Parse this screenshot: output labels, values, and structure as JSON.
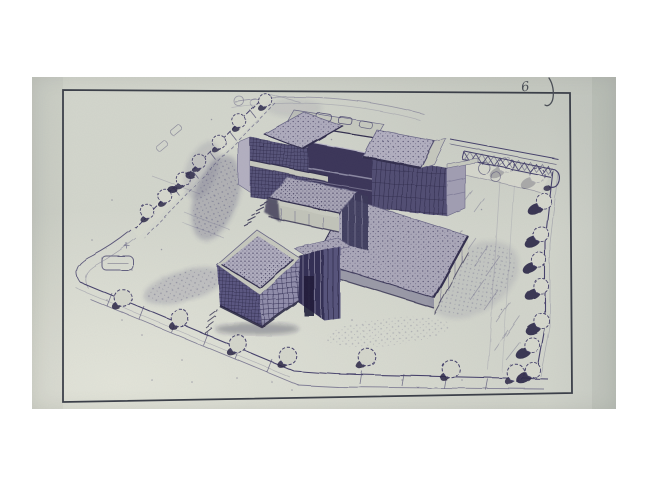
{
  "document": {
    "kind": "scanned architectural perspective drawing",
    "subject": "aerial perspective rendering of a flat-roofed modernist building complex on a landscaped corner site",
    "annotation_glyph": "6",
    "annotation_note": "handwritten pencil mark with hook stroke, top-right above the border"
  },
  "scene": {
    "frame": "hand-drawn rectangular border around the drawing",
    "building_parts": [
      "rear slab with gridded curtain-wall facade",
      "left rooftop box with stippled roof",
      "dark middle rooftop box with window band",
      "right rooftop box with stippled roof",
      "front terrace parapet",
      "front-centre stippled-roof block",
      "front cube pavilion with gridded facades",
      "recessed entrance link with vertical mullions",
      "low right wing with stippled roof and light walls",
      "entry steps"
    ],
    "site_features": [
      "tree-lined hedge walk on upper-left boundary",
      "bottom perimeter road with tick marks and street trees",
      "right boundary with trees casting heavy shadows",
      "trellis / pergola walk with X-lattice at upper right",
      "curved service path above the building",
      "rounded turning loop at lower-left corner",
      "pencil-shaded ground smudges"
    ],
    "tree_counts": {
      "hedge_row": 7,
      "bottom_road": 7,
      "right_edge": 9,
      "near_trellis": 2
    }
  },
  "colors": {
    "ink": "#454166",
    "inkDark": "#322e4e",
    "inkMid": "#6b6887",
    "paper": "#d2d5cb",
    "frame": "#3a3e47",
    "wallLight": "#c9cbc0",
    "roofStipple": "#aaa7b8",
    "shadow": "#25213f",
    "pencil": "#4a4e55",
    "margin": "#ffffff"
  }
}
